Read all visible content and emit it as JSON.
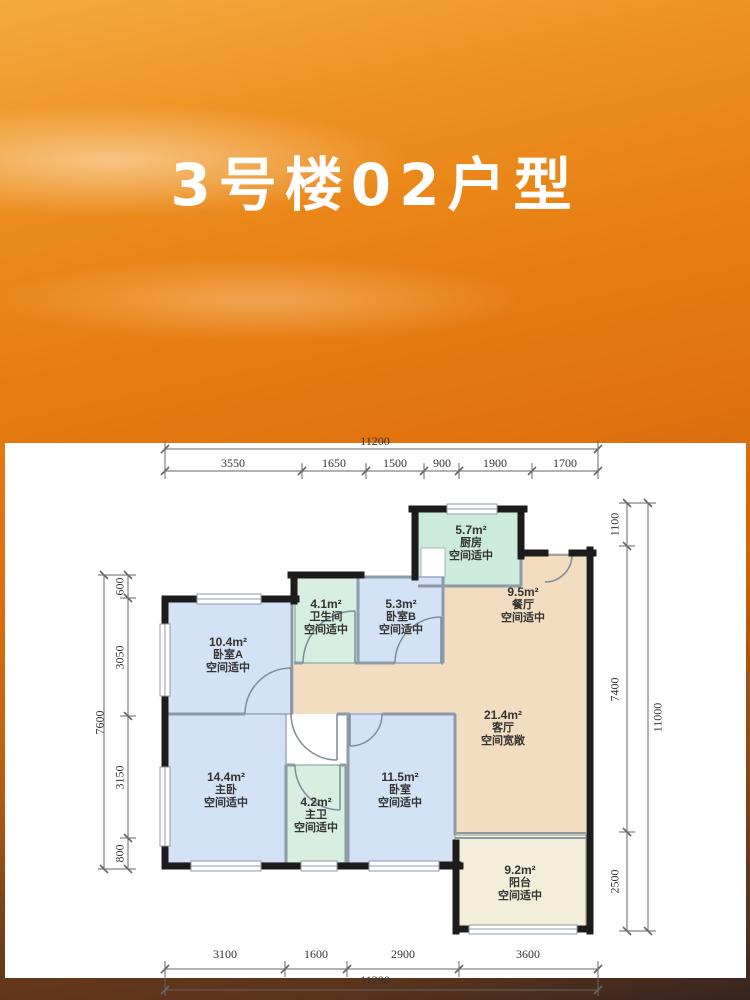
{
  "title": "3号楼02户型",
  "colors": {
    "accent_orange": "#e0720e",
    "wall_black": "#1c1c1c",
    "room_blue": "#d3e2f5",
    "room_green": "#d8eee1",
    "room_tan": "#f2ddc0",
    "room_cream": "#f2eed9",
    "panel_white": "#ffffff"
  },
  "plan": {
    "rooms": [
      {
        "id": "kitchen",
        "area": "5.7m²",
        "name": "厨房",
        "note": "空间适中"
      },
      {
        "id": "dining",
        "area": "9.5m²",
        "name": "餐厅",
        "note": "空间适中"
      },
      {
        "id": "bathroom",
        "area": "4.1m²",
        "name": "卫生间",
        "note": "空间适中"
      },
      {
        "id": "bedroom-b",
        "area": "5.3m²",
        "name": "卧室B",
        "note": "空间适中"
      },
      {
        "id": "bedroom-a",
        "area": "10.4m²",
        "name": "卧室A",
        "note": "空间适中"
      },
      {
        "id": "living",
        "area": "21.4m²",
        "name": "客厅",
        "note": "空间宽敞"
      },
      {
        "id": "master",
        "area": "14.4m²",
        "name": "主卧",
        "note": "空间适中"
      },
      {
        "id": "master-bath",
        "area": "4.2m²",
        "name": "主卫",
        "note": "空间适中"
      },
      {
        "id": "bedroom",
        "area": "11.5m²",
        "name": "卧室",
        "note": "空间适中"
      },
      {
        "id": "balcony",
        "area": "9.2m²",
        "name": "阳台",
        "note": "空间适中"
      }
    ],
    "dims": {
      "top": {
        "total": "11200",
        "segments": [
          "3550",
          "1650",
          "1500",
          "900",
          "1900",
          "1700"
        ]
      },
      "bottom": {
        "total": "11200",
        "segments": [
          "3100",
          "1600",
          "2900",
          "3600"
        ]
      },
      "left": {
        "total": "7600",
        "segments": [
          "600",
          "3050",
          "3150",
          "800"
        ]
      },
      "right": {
        "total": "11000",
        "segments": [
          "1100",
          "7400",
          "2500"
        ]
      }
    }
  }
}
